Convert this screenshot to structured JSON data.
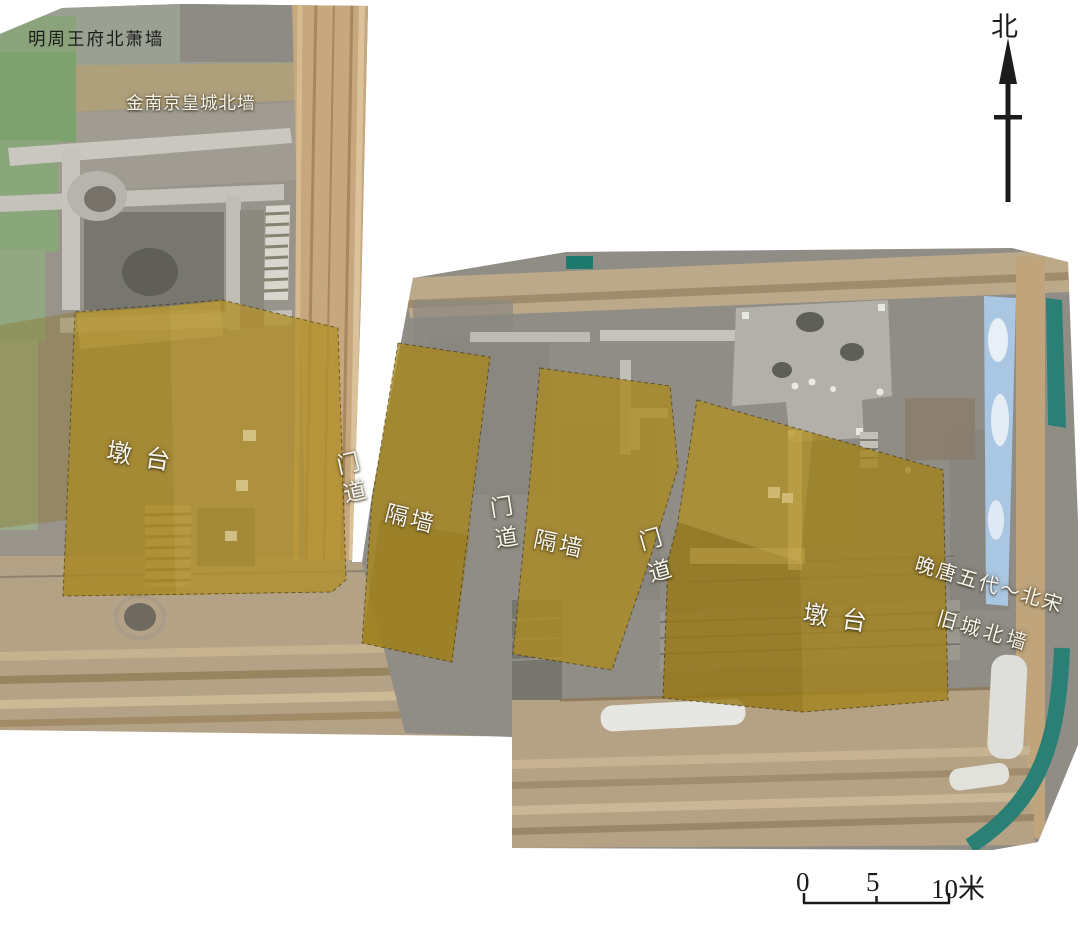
{
  "figure": {
    "type": "archaeological orthophoto plan with highlighted structures",
    "background_color": "#ffffff"
  },
  "labels": {
    "ming_wall": "明周王府北萧墙",
    "jin_wall": "金南京皇城北墙",
    "pier_left": "墩台",
    "gate_1": "门道",
    "wall_1": "隔墙",
    "gate_2": "门道",
    "wall_2": "隔墙",
    "gate_3": "门道",
    "pier_right": "墩台",
    "late_tang_song_wall_line1": "晚唐五代～北宋",
    "late_tang_song_wall_line2": "旧城北墙"
  },
  "compass": {
    "north": "北"
  },
  "scale_bar": {
    "start": "0",
    "middle": "5",
    "end": "10米"
  },
  "colors": {
    "highlight_ochre": "#a8871f",
    "highlight_ochre_light": "#b1902a",
    "highlight_ochre_dark": "#967713",
    "photo_gray": "#938f88",
    "photo_tan": "#c2a77f",
    "green_tarp": "#7da26e",
    "teal_tarp": "#2a8075",
    "blue_tarp": "#a9c6e2",
    "label_white": "#f7f5ee",
    "label_black": "#1b1b1b"
  }
}
